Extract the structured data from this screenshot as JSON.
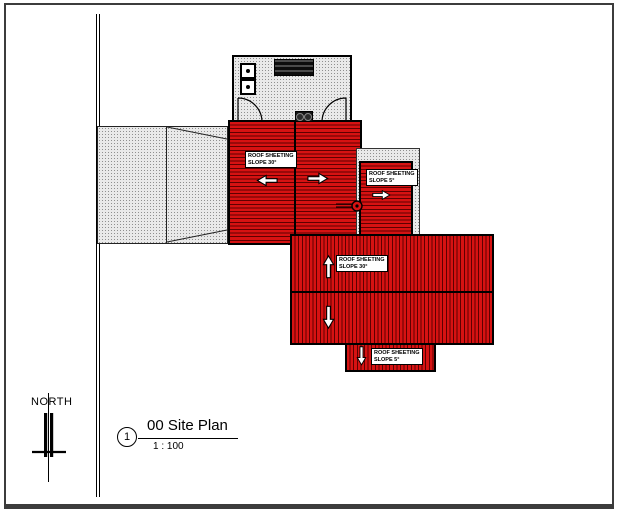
{
  "sheet": {
    "north_label": "NORTH",
    "view_title": {
      "number": "1",
      "name": "00 Site Plan",
      "scale": "1 : 100"
    }
  },
  "roof_labels": {
    "west": {
      "line1": "ROOF SHEETING",
      "line2": "SLOPE 30°"
    },
    "east": {
      "line1": "ROOF SHEETING",
      "line2": "SLOPE 5°"
    },
    "main": {
      "line1": "ROOF SHEETING",
      "line2": "SLOPE 30°"
    },
    "south": {
      "line1": "ROOF SHEETING",
      "line2": "SLOPE 5°"
    }
  },
  "colors": {
    "roof_red": "#d61212",
    "corrugation_dark": "#5e0000",
    "hatch_gray": "#e9e9e9",
    "line_black": "#000000"
  }
}
